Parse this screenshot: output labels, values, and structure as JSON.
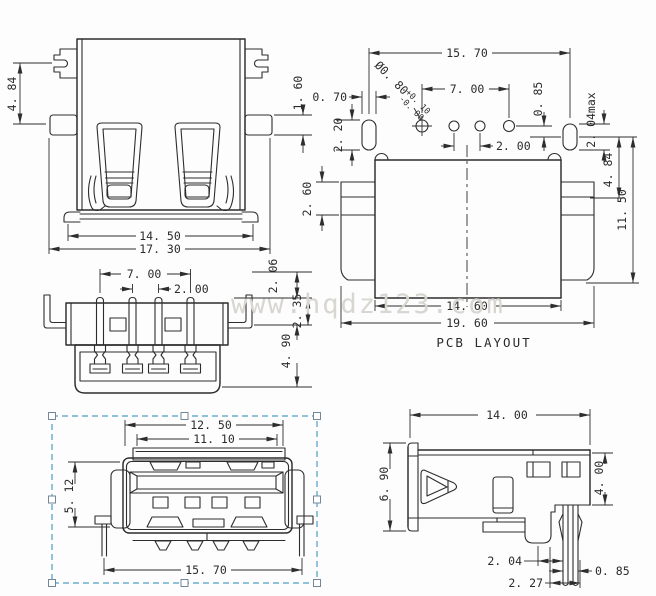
{
  "canvas": {
    "background": "#fdfdfd",
    "line_color": "#2d2d2d",
    "selection_color": "#4d9fc7",
    "watermark_color": "#d8d6d0"
  },
  "watermark": "www.hqdz123.com",
  "front_view": {
    "dim_side_height": "4. 84",
    "dim_flange": "1. 60",
    "dim_shell_width": "14. 50",
    "dim_total_width": "17. 30"
  },
  "pcb_layout": {
    "title": "PCB LAYOUT",
    "dim_pad_span": "15. 70",
    "dim_pin_span": "7. 00",
    "dim_pad_width": "0. 70",
    "dim_pad_height": "2. 20",
    "dim_pin_pitch": "2. 00",
    "dim_offset": "0. 85",
    "dim_pad_max": "2. 04max",
    "dim_row_gap": "4. 84",
    "dim_depth": "11. 50",
    "dim_tab": "2. 60",
    "dim_body_width": "14. 60",
    "dim_total_width": "19. 60",
    "hole_dia": "Ø0. 80",
    "hole_tol_plus": "+0. 10",
    "hole_tol_minus": "-0. 00"
  },
  "bottom_view": {
    "dim_pin_span": "7. 00",
    "dim_pin_pitch": "2. 00",
    "dim_tip": "2. 06",
    "dim_mid": "2. 35",
    "dim_body": "4. 90"
  },
  "top_view": {
    "dim_width_outer": "12. 50",
    "dim_width_inner": "11. 10",
    "dim_height": "5. 12",
    "dim_leg_span": "15. 70"
  },
  "side_view": {
    "dim_length": "14. 00",
    "dim_height": "6. 90",
    "dim_right_height": "4. 00",
    "dim_leg_a": "2. 04",
    "dim_leg_width": "0. 85",
    "dim_leg_b": "2. 27"
  }
}
